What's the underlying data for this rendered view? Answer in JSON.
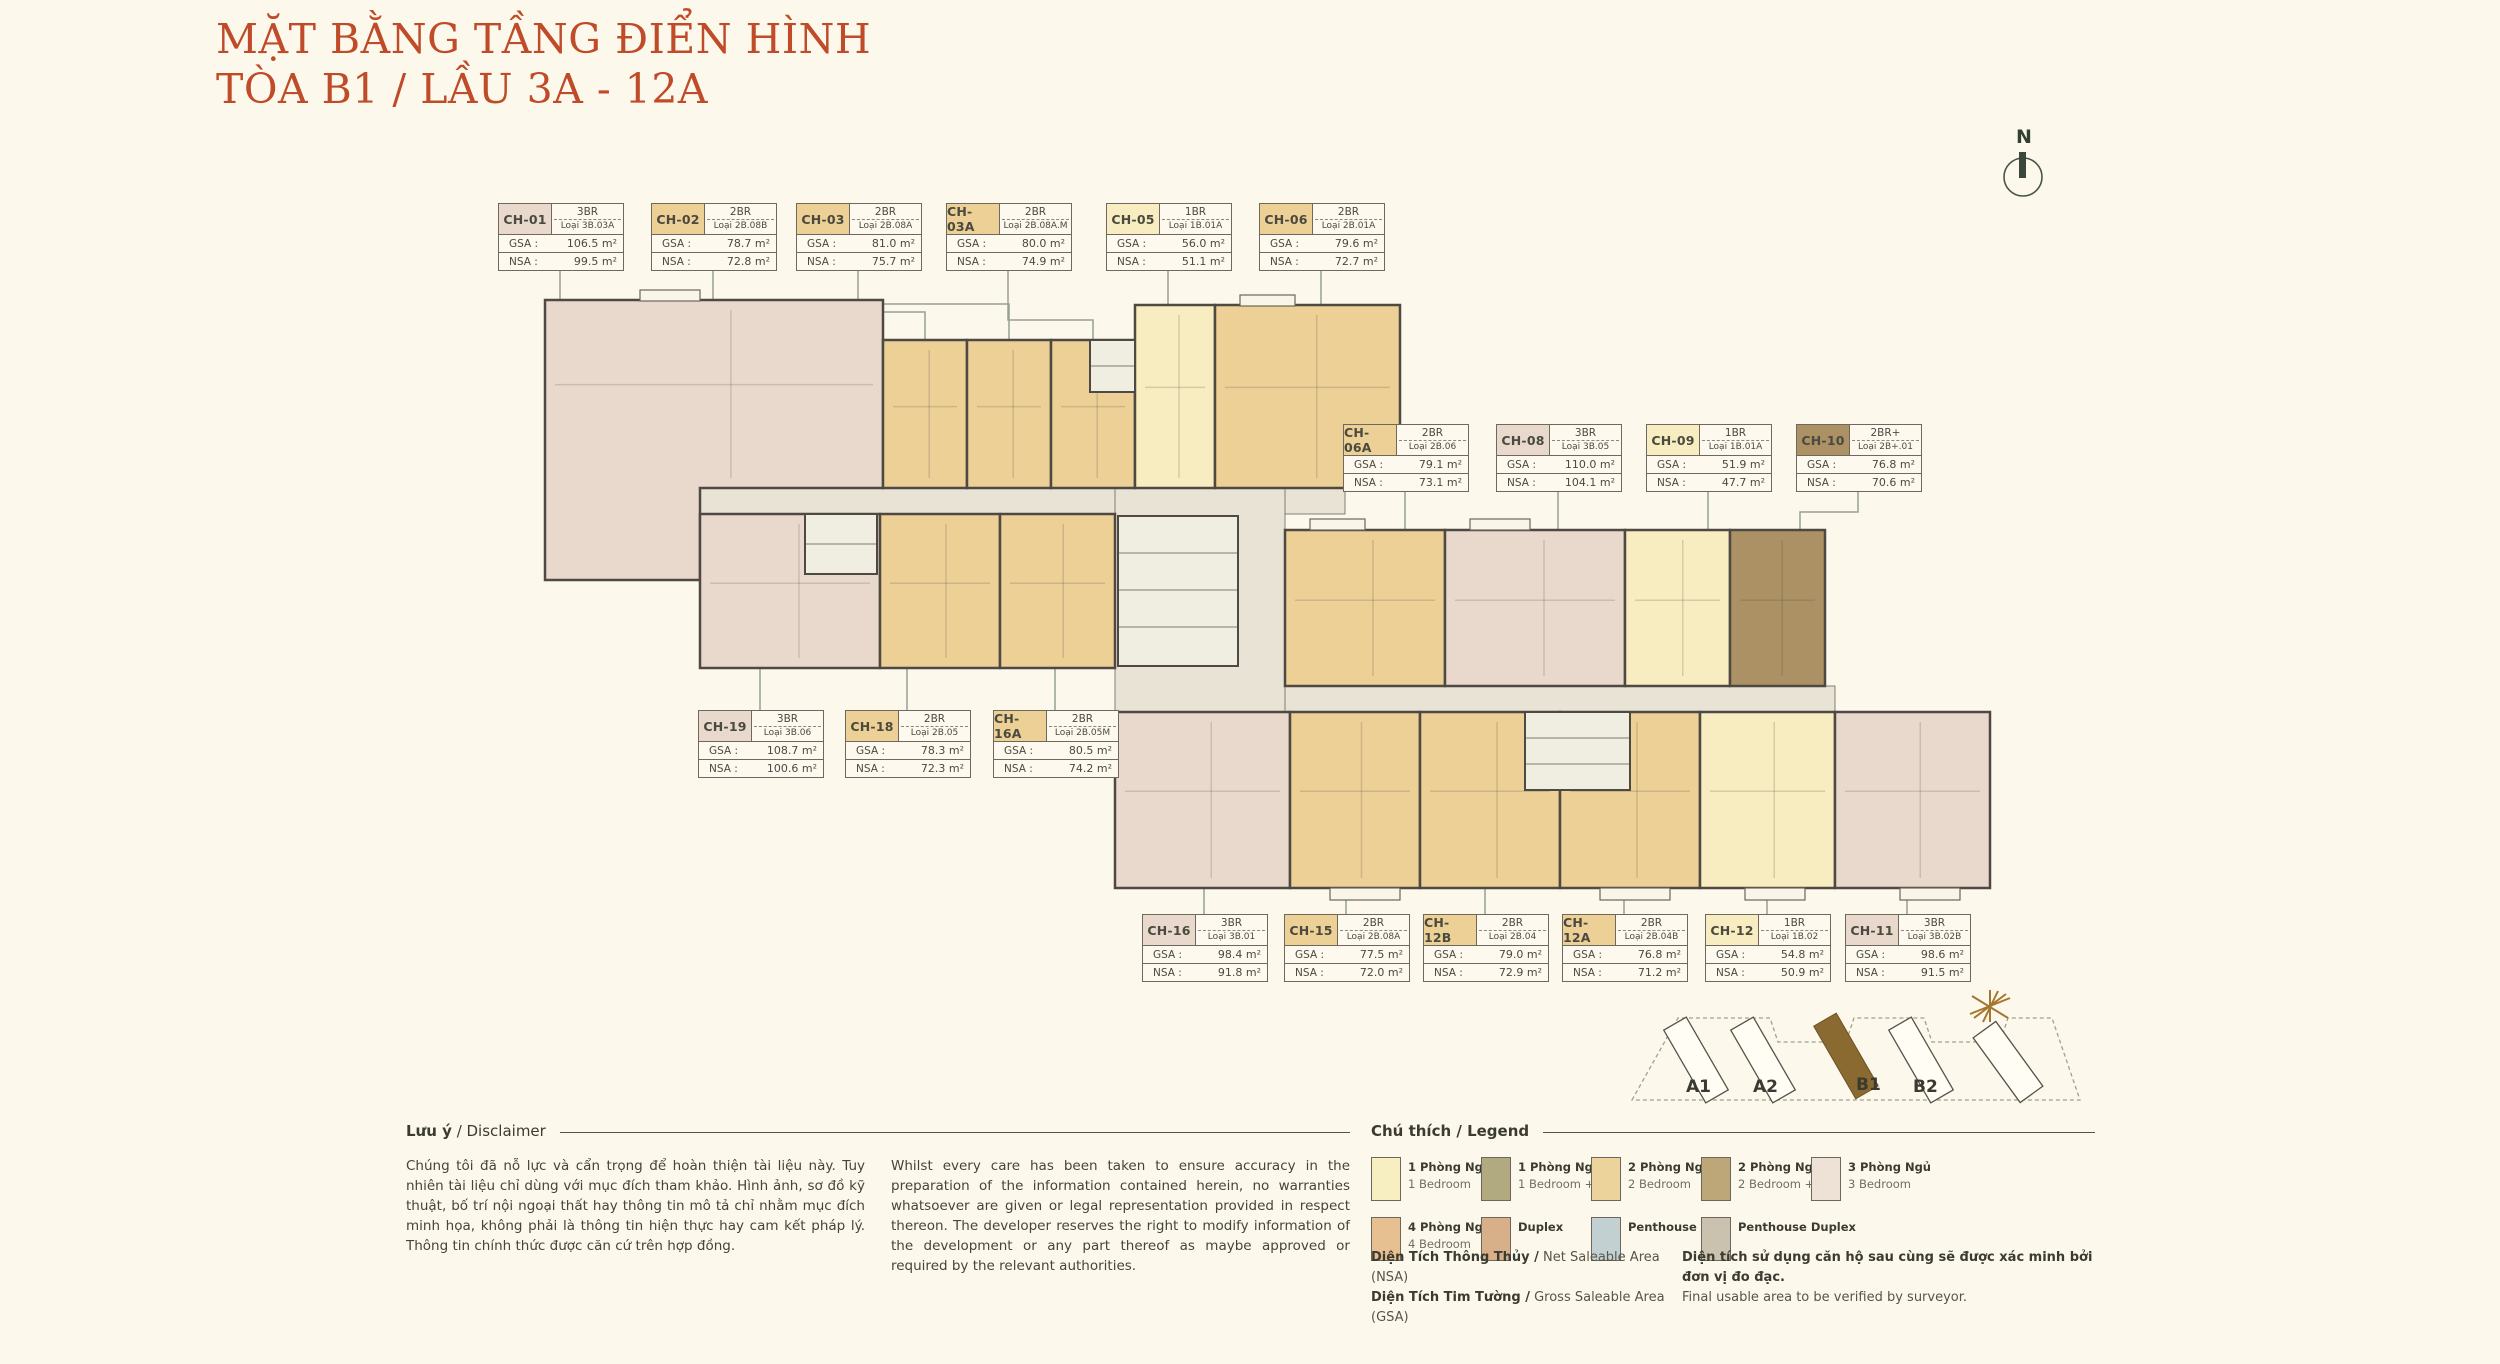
{
  "title": {
    "line1": "MẶT BẰNG TẦNG ĐIỂN HÌNH",
    "line2": "TÒA B1 / LẦU 3A - 12A"
  },
  "compass": "N",
  "labels": {
    "gsa": "GSA :",
    "nsa": "NSA :"
  },
  "units": [
    {
      "id": "CH-01",
      "br": "3BR",
      "loai": "Loại 3B.03A",
      "gsa": "106.5 m²",
      "nsa": "99.5 m²",
      "type": "3br"
    },
    {
      "id": "CH-02",
      "br": "2BR",
      "loai": "Loại 2B.08B",
      "gsa": "78.7 m²",
      "nsa": "72.8 m²",
      "type": "2br"
    },
    {
      "id": "CH-03",
      "br": "2BR",
      "loai": "Loại 2B.08A",
      "gsa": "81.0 m²",
      "nsa": "75.7 m²",
      "type": "2br"
    },
    {
      "id": "CH-03A",
      "br": "2BR",
      "loai": "Loại 2B.08A.M",
      "gsa": "80.0 m²",
      "nsa": "74.9 m²",
      "type": "2br"
    },
    {
      "id": "CH-05",
      "br": "1BR",
      "loai": "Loại 1B.01A",
      "gsa": "56.0 m²",
      "nsa": "51.1 m²",
      "type": "1br"
    },
    {
      "id": "CH-06",
      "br": "2BR",
      "loai": "Loại 2B.01A",
      "gsa": "79.6 m²",
      "nsa": "72.7 m²",
      "type": "2br"
    },
    {
      "id": "CH-06A",
      "br": "2BR",
      "loai": "Loại 2B.06",
      "gsa": "79.1 m²",
      "nsa": "73.1 m²",
      "type": "2br"
    },
    {
      "id": "CH-08",
      "br": "3BR",
      "loai": "Loại 3B.05",
      "gsa": "110.0 m²",
      "nsa": "104.1 m²",
      "type": "3br"
    },
    {
      "id": "CH-09",
      "br": "1BR",
      "loai": "Loại 1B.01A",
      "gsa": "51.9 m²",
      "nsa": "47.7 m²",
      "type": "1br"
    },
    {
      "id": "CH-10",
      "br": "2BR+",
      "loai": "Loại 2B+.01",
      "gsa": "76.8 m²",
      "nsa": "70.6 m²",
      "type": "2brplus"
    },
    {
      "id": "CH-19",
      "br": "3BR",
      "loai": "Loại 3B.06",
      "gsa": "108.7 m²",
      "nsa": "100.6 m²",
      "type": "3br"
    },
    {
      "id": "CH-18",
      "br": "2BR",
      "loai": "Loại 2B.05",
      "gsa": "78.3 m²",
      "nsa": "72.3 m²",
      "type": "2br"
    },
    {
      "id": "CH-16A",
      "br": "2BR",
      "loai": "Loại 2B.05M",
      "gsa": "80.5 m²",
      "nsa": "74.2 m²",
      "type": "2br"
    },
    {
      "id": "CH-16",
      "br": "3BR",
      "loai": "Loại 3B.01",
      "gsa": "98.4 m²",
      "nsa": "91.8 m²",
      "type": "3br"
    },
    {
      "id": "CH-15",
      "br": "2BR",
      "loai": "Loại 2B.08A",
      "gsa": "77.5 m²",
      "nsa": "72.0 m²",
      "type": "2br"
    },
    {
      "id": "CH-12B",
      "br": "2BR",
      "loai": "Loại 2B.04",
      "gsa": "79.0 m²",
      "nsa": "72.9 m²",
      "type": "2br"
    },
    {
      "id": "CH-12A",
      "br": "2BR",
      "loai": "Loại 2B.04B",
      "gsa": "76.8 m²",
      "nsa": "71.2 m²",
      "type": "2br"
    },
    {
      "id": "CH-12",
      "br": "1BR",
      "loai": "Loại 1B.02",
      "gsa": "54.8 m²",
      "nsa": "50.9 m²",
      "type": "1br"
    },
    {
      "id": "CH-11",
      "br": "3BR",
      "loai": "Loại 3B.02B",
      "gsa": "98.6 m²",
      "nsa": "91.5 m²",
      "type": "3br"
    }
  ],
  "colors": {
    "types": {
      "1br": "#f7edc0",
      "2br": "#ecd096",
      "2brplus": "#ab9164",
      "3br": "#e9d9cc"
    },
    "corridor": "#e8e3d5",
    "wall": "#4e4a43",
    "leader": "#96a096",
    "highlight_building": "#8a6a31"
  },
  "legend": {
    "heading": "Chú thích / Legend",
    "items": [
      {
        "vi": "1 Phòng Ngủ",
        "en": "1 Bedroom",
        "color": "#f7eec1"
      },
      {
        "vi": "1 Phòng Ngủ +",
        "en": "1 Bedroom +",
        "color": "#b1aa81"
      },
      {
        "vi": "2 Phòng Ngủ",
        "en": "2 Bedroom",
        "color": "#ecd39c"
      },
      {
        "vi": "2 Phòng Ngủ +",
        "en": "2 Bedroom +",
        "color": "#bda677"
      },
      {
        "vi": "3 Phòng Ngủ",
        "en": "3 Bedroom",
        "color": "#eee1d5"
      },
      {
        "vi": "4 Phòng Ngủ",
        "en": "4 Bedroom",
        "color": "#e6c091"
      },
      {
        "vi": "Duplex",
        "en": "",
        "color": "#d7b08a"
      },
      {
        "vi": "Penthouse",
        "en": "",
        "color": "#c3d0d2"
      },
      {
        "vi": "Penthouse Duplex",
        "en": "",
        "color": "#cac1ae"
      }
    ]
  },
  "disclaimer": {
    "heading_bold": "Lưu ý",
    "heading_rest": " / Disclaimer",
    "vi": "Chúng tôi đã nỗ lực và cẩn trọng để hoàn thiện tài liệu này. Tuy nhiên tài liệu chỉ dùng với mục đích tham khảo. Hình ảnh, sơ đồ kỹ thuật, bố trí nội ngoại thất hay thông tin mô tả chỉ nhằm mục đích minh họa, không phải là thông tin hiện thực hay cam kết pháp lý. Thông tin chính thức được căn cứ trên hợp đồng.",
    "en": "Whilst every care has been taken to ensure accuracy in the preparation of the information contained herein, no warranties whatsoever are given or legal representation provided in respect thereon. The developer reserves the right to modify information of the development or any part thereof as maybe approved or required by the relevant authorities."
  },
  "footnotes": {
    "nsa_bold": "Diện Tích Thông Thủy /",
    "nsa_rest": " Net Saleable Area (NSA)",
    "gsa_bold": "Diện Tích Tim Tường /",
    "gsa_rest": " Gross Saleable Area (GSA)",
    "note_bold": "Diện tích sử dụng căn hộ sau cùng sẽ được xác minh bởi đơn vị đo đạc.",
    "note_rest": "Final usable area to be verified by surveyor."
  },
  "sitemap": {
    "buildings": [
      "A1",
      "A2",
      "B1",
      "B2"
    ],
    "highlight": "B1"
  }
}
